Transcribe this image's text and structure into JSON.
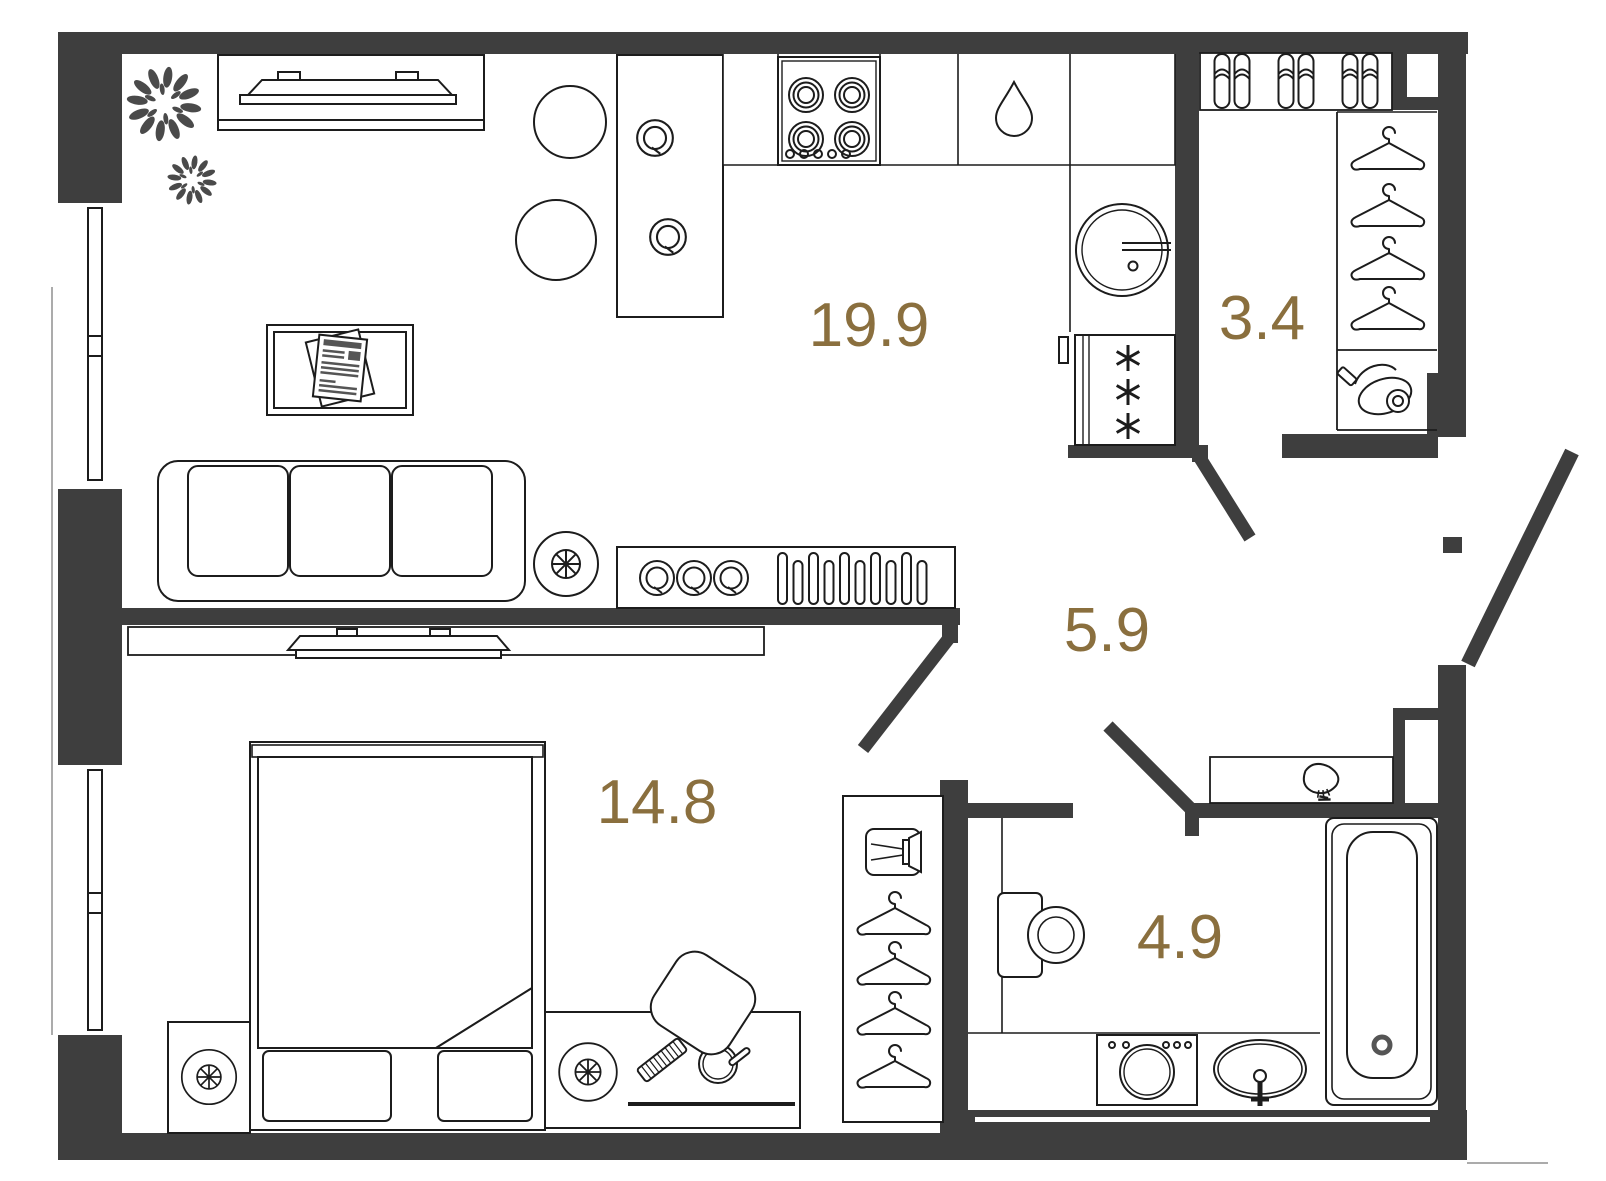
{
  "floor_plan": {
    "rooms": [
      {
        "name": "kitchen-living-room",
        "area_label": "19.9"
      },
      {
        "name": "wardrobe-closet",
        "area_label": "3.4"
      },
      {
        "name": "hallway",
        "area_label": "5.9"
      },
      {
        "name": "bedroom",
        "area_label": "14.8"
      },
      {
        "name": "bathroom",
        "area_label": "4.9"
      }
    ],
    "colors": {
      "wall": "#3E3E3E",
      "furniture_line": "#1C1C1C",
      "area_label": "#8A6F3E",
      "plant": "#4A4A4A",
      "background": "#FFFFFF",
      "outside_line": "#ABABAB"
    },
    "furniture_icons": [
      "tv-icon",
      "plant-icon",
      "coffee-table-icon",
      "magazine-icon",
      "sofa-icon",
      "fan-icon",
      "sideboard-icon",
      "plate-icon",
      "dish-rack-icon",
      "dining-table-icon",
      "chair-icon",
      "stove-icon",
      "water-drop-icon",
      "kitchen-sink-icon",
      "fridge-icon",
      "slippers-icon",
      "hanger-icon",
      "vacuum-cleaner-icon",
      "bed-icon",
      "pillow-icon",
      "nightstand-icon",
      "dressing-table-icon",
      "comb-icon",
      "hand-mirror-icon",
      "stool-icon",
      "wardrobe-icon",
      "media-box-icon",
      "brush-icon",
      "toilet-icon",
      "washing-machine-icon",
      "bathroom-sink-icon",
      "bathtub-icon",
      "window-icon",
      "door-swing-icon"
    ]
  }
}
